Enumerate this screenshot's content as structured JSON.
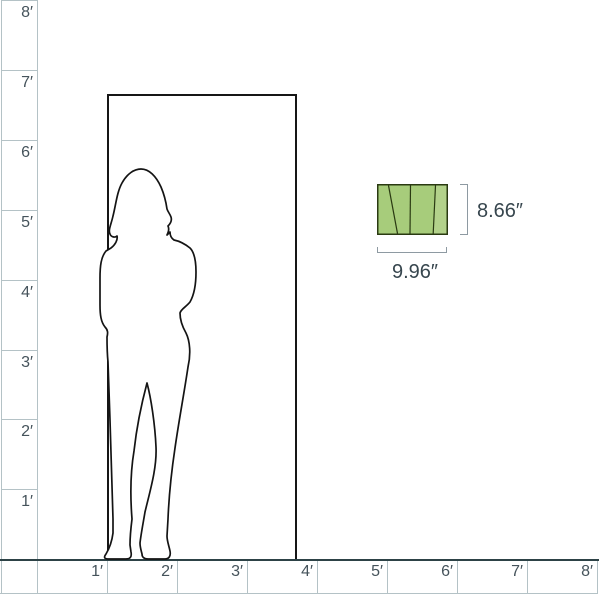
{
  "diagram": {
    "name": "product-size-comparison",
    "unit": "feet"
  },
  "scale": {
    "left_labels": [
      "8′",
      "7′",
      "6′",
      "5′",
      "4′",
      "3′",
      "2′",
      "1′"
    ],
    "bottom_labels": [
      "1′",
      "2′",
      "3′",
      "4′",
      "5′",
      "6′",
      "7′",
      "8′"
    ]
  },
  "reference_objects": {
    "door": "door-frame",
    "person": "standing-woman-silhouette"
  },
  "product": {
    "height_label": "8.66″",
    "width_label": "9.96″"
  },
  "colors": {
    "ruler_line": "#b4c2c6",
    "floor_line": "#2d4246",
    "ruler_text": "#45535b",
    "dimension_text": "#37464e",
    "bracket": "#8e9aa2",
    "outline": "#161616",
    "product_fill": "#a7cc7b",
    "product_fill_light": "#b3d28b",
    "product_outline": "#2a3a12"
  }
}
